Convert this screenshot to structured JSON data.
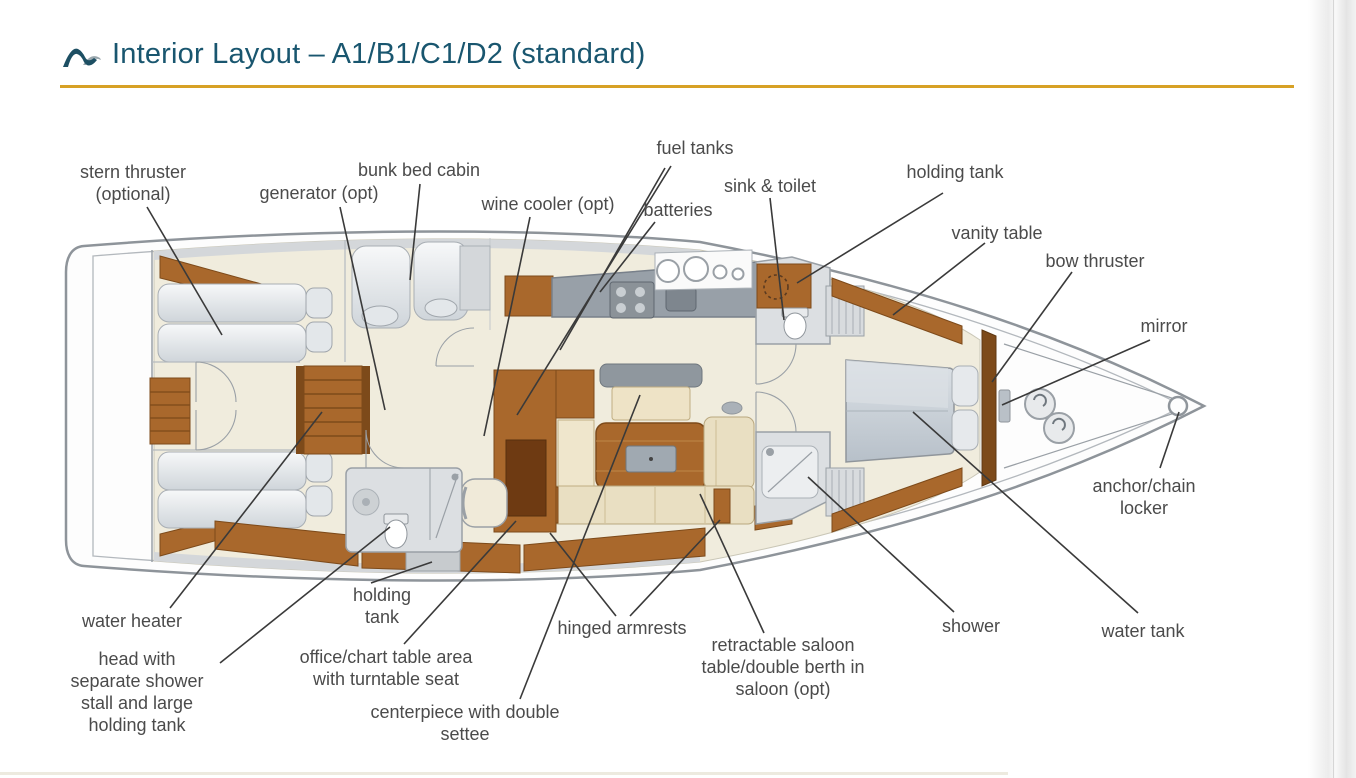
{
  "header": {
    "title": "Interior Layout – A1/B1/C1/D2 (standard)"
  },
  "diagram": {
    "type": "yacht-interior-floorplan",
    "labels": [
      {
        "id": "stern-thruster",
        "text": "stern thruster\n(optional)"
      },
      {
        "id": "generator",
        "text": "generator (opt)"
      },
      {
        "id": "bunk-bed-cabin",
        "text": "bunk bed cabin"
      },
      {
        "id": "wine-cooler",
        "text": "wine cooler (opt)"
      },
      {
        "id": "fuel-tanks",
        "text": "fuel tanks"
      },
      {
        "id": "batteries",
        "text": "batteries"
      },
      {
        "id": "sink-toilet",
        "text": "sink & toilet"
      },
      {
        "id": "holding-tank-forward",
        "text": "holding tank"
      },
      {
        "id": "vanity-table",
        "text": "vanity table"
      },
      {
        "id": "bow-thruster",
        "text": "bow thruster"
      },
      {
        "id": "mirror",
        "text": "mirror"
      },
      {
        "id": "anchor-chain-locker",
        "text": "anchor/chain\nlocker"
      },
      {
        "id": "water-heater",
        "text": "water heater"
      },
      {
        "id": "head-with-shower",
        "text": "head with\nseparate shower\nstall and large\nholding tank"
      },
      {
        "id": "holding-tank-aft",
        "text": "holding\ntank"
      },
      {
        "id": "office-chart-table",
        "text": "office/chart table area\nwith turntable seat"
      },
      {
        "id": "centerpiece",
        "text": "centerpiece with double\nsettee"
      },
      {
        "id": "hinged-armrests",
        "text": "hinged armrests"
      },
      {
        "id": "retractable-table",
        "text": "retractable saloon\ntable/double berth in\nsaloon (opt)"
      },
      {
        "id": "shower",
        "text": "shower"
      },
      {
        "id": "water-tank",
        "text": "water tank"
      }
    ],
    "colors": {
      "wood": "#a9682c",
      "wood_dark": "#7d4a1a",
      "floor_cream": "#f0ecdd",
      "upholstery_cream": "#e9dfc2",
      "fixture_gray": "#dcdfe2",
      "counter_gray": "#98a0a8",
      "accent_gold": "#d7a125",
      "title_teal": "#19566f",
      "label_gray": "#4b4b4b"
    }
  }
}
